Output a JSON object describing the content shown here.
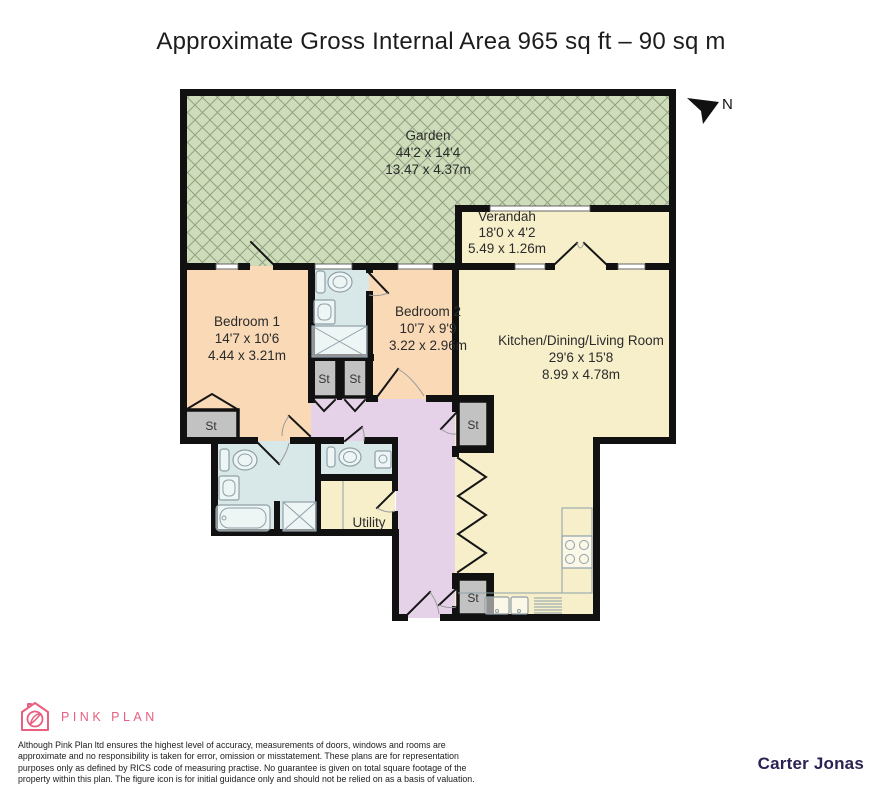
{
  "title": "Approximate Gross Internal Area 965 sq ft – 90 sq m",
  "compass": {
    "north_label": "N"
  },
  "rooms": {
    "garden": {
      "name": "Garden",
      "size_imperial": "44'2 x 14'4",
      "size_metric": "13.47 x 4.37m"
    },
    "verandah": {
      "name": "Verandah",
      "size_imperial": "18'0 x 4'2",
      "size_metric": "5.49 x 1.26m"
    },
    "bedroom1": {
      "name": "Bedroom 1",
      "size_imperial": "14'7 x 10'6",
      "size_metric": "4.44 x 3.21m"
    },
    "bedroom2": {
      "name": "Bedroom 2",
      "size_imperial": "10'7 x 9'9",
      "size_metric": "3.22 x 2.96m"
    },
    "kitchen": {
      "name": "Kitchen/Dining/Living Room",
      "size_imperial": "29'6 x 15'8",
      "size_metric": "8.99 x 4.78m"
    },
    "utility": {
      "name": "Utility"
    },
    "storage_abbrev": "St"
  },
  "footer": {
    "brand": "PINK PLAN",
    "disclaimer": [
      "Although Pink Plan ltd ensures the highest level of accuracy, measurements of doors, windows and rooms are",
      "approximate and no responsibility is taken for error, omission or misstatement. These plans are for representation",
      "purposes only as defined by RICS code of measuring practise. No guarantee is given on total square footage of the",
      "property within this plan. The figure icon is for initial guidance only and should not be relied on as a basis of valuation."
    ],
    "agent": "Carter Jonas"
  },
  "colors": {
    "garden": "#cfdcba",
    "garden_hatch": "#8fa183",
    "cream": "#f6efca",
    "peach": "#f9d9b6",
    "bathroom_blue": "#d8e8e8",
    "hallway_lilac": "#e5d2e9",
    "storage_gray": "#c2c2c2",
    "wall": "#111111",
    "brand_pink": "#e85f80",
    "agent_navy": "#2b2254"
  }
}
